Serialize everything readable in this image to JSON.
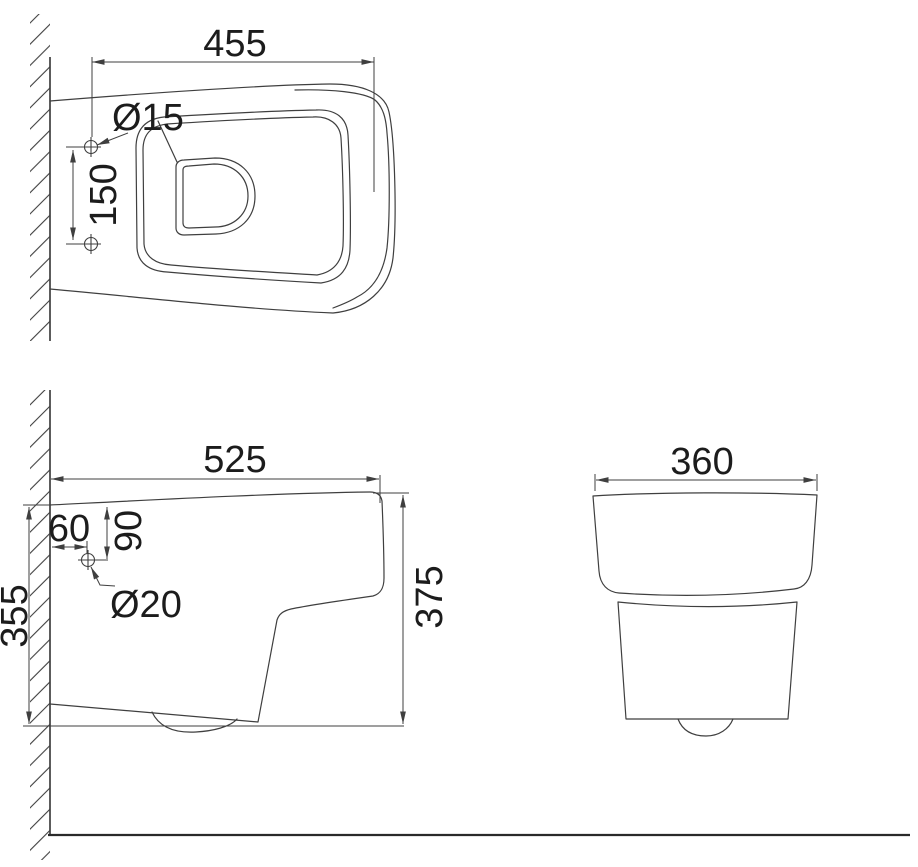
{
  "colors": {
    "background": "#ffffff",
    "line": "#3f3f3f",
    "floor": "#2a2a2a",
    "text": "#1c1c1c"
  },
  "views": {
    "top": {
      "dims": {
        "width": "455",
        "hole_diameter": "Ø15",
        "hole_spacing": "150"
      }
    },
    "side": {
      "dims": {
        "depth": "525",
        "hole_offset_from_wall": "60",
        "hole_offset_from_top": "90",
        "hole_diameter": "Ø20",
        "height_at_wall": "355",
        "height_overall": "375"
      }
    },
    "front": {
      "dims": {
        "width": "360"
      }
    }
  }
}
